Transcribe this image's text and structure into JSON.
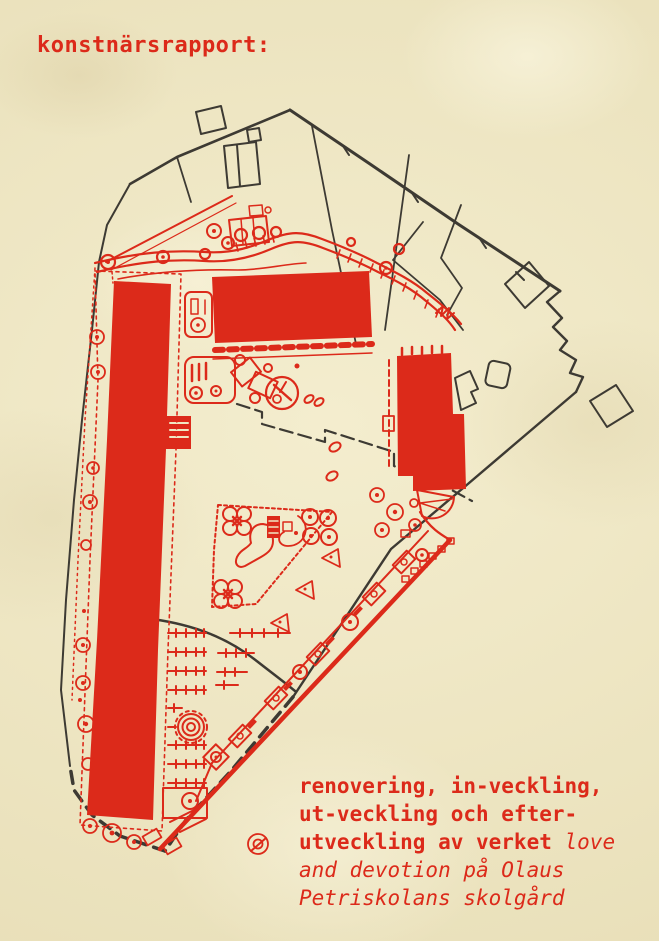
{
  "page": {
    "title": "konstnärsrapport:"
  },
  "caption": {
    "lines": [
      [
        {
          "text": "renovering, in-veckling,",
          "style": "bold"
        }
      ],
      [
        {
          "text": "ut-veckling och efter-",
          "style": "bold"
        }
      ],
      [
        {
          "text": "utveckling av verket ",
          "style": "bold"
        },
        {
          "text": "love",
          "style": "italic"
        }
      ],
      [
        {
          "text": "and devotion på Olaus",
          "style": "italic"
        }
      ],
      [
        {
          "text": "Petriskolans skolgård",
          "style": "italic"
        }
      ]
    ]
  },
  "colors": {
    "paper": "#f0e8c3",
    "red": "#dc2a1a",
    "ink": "#3d3a33"
  },
  "map": {
    "features": [
      "site-boundary",
      "neighbor-plot-lines",
      "school-building-long-west",
      "school-building-center",
      "school-building-east",
      "winding-path",
      "playground-area",
      "diagonal-walkway",
      "spiral-feature",
      "parking-ladder-rows",
      "tree-icons"
    ]
  }
}
